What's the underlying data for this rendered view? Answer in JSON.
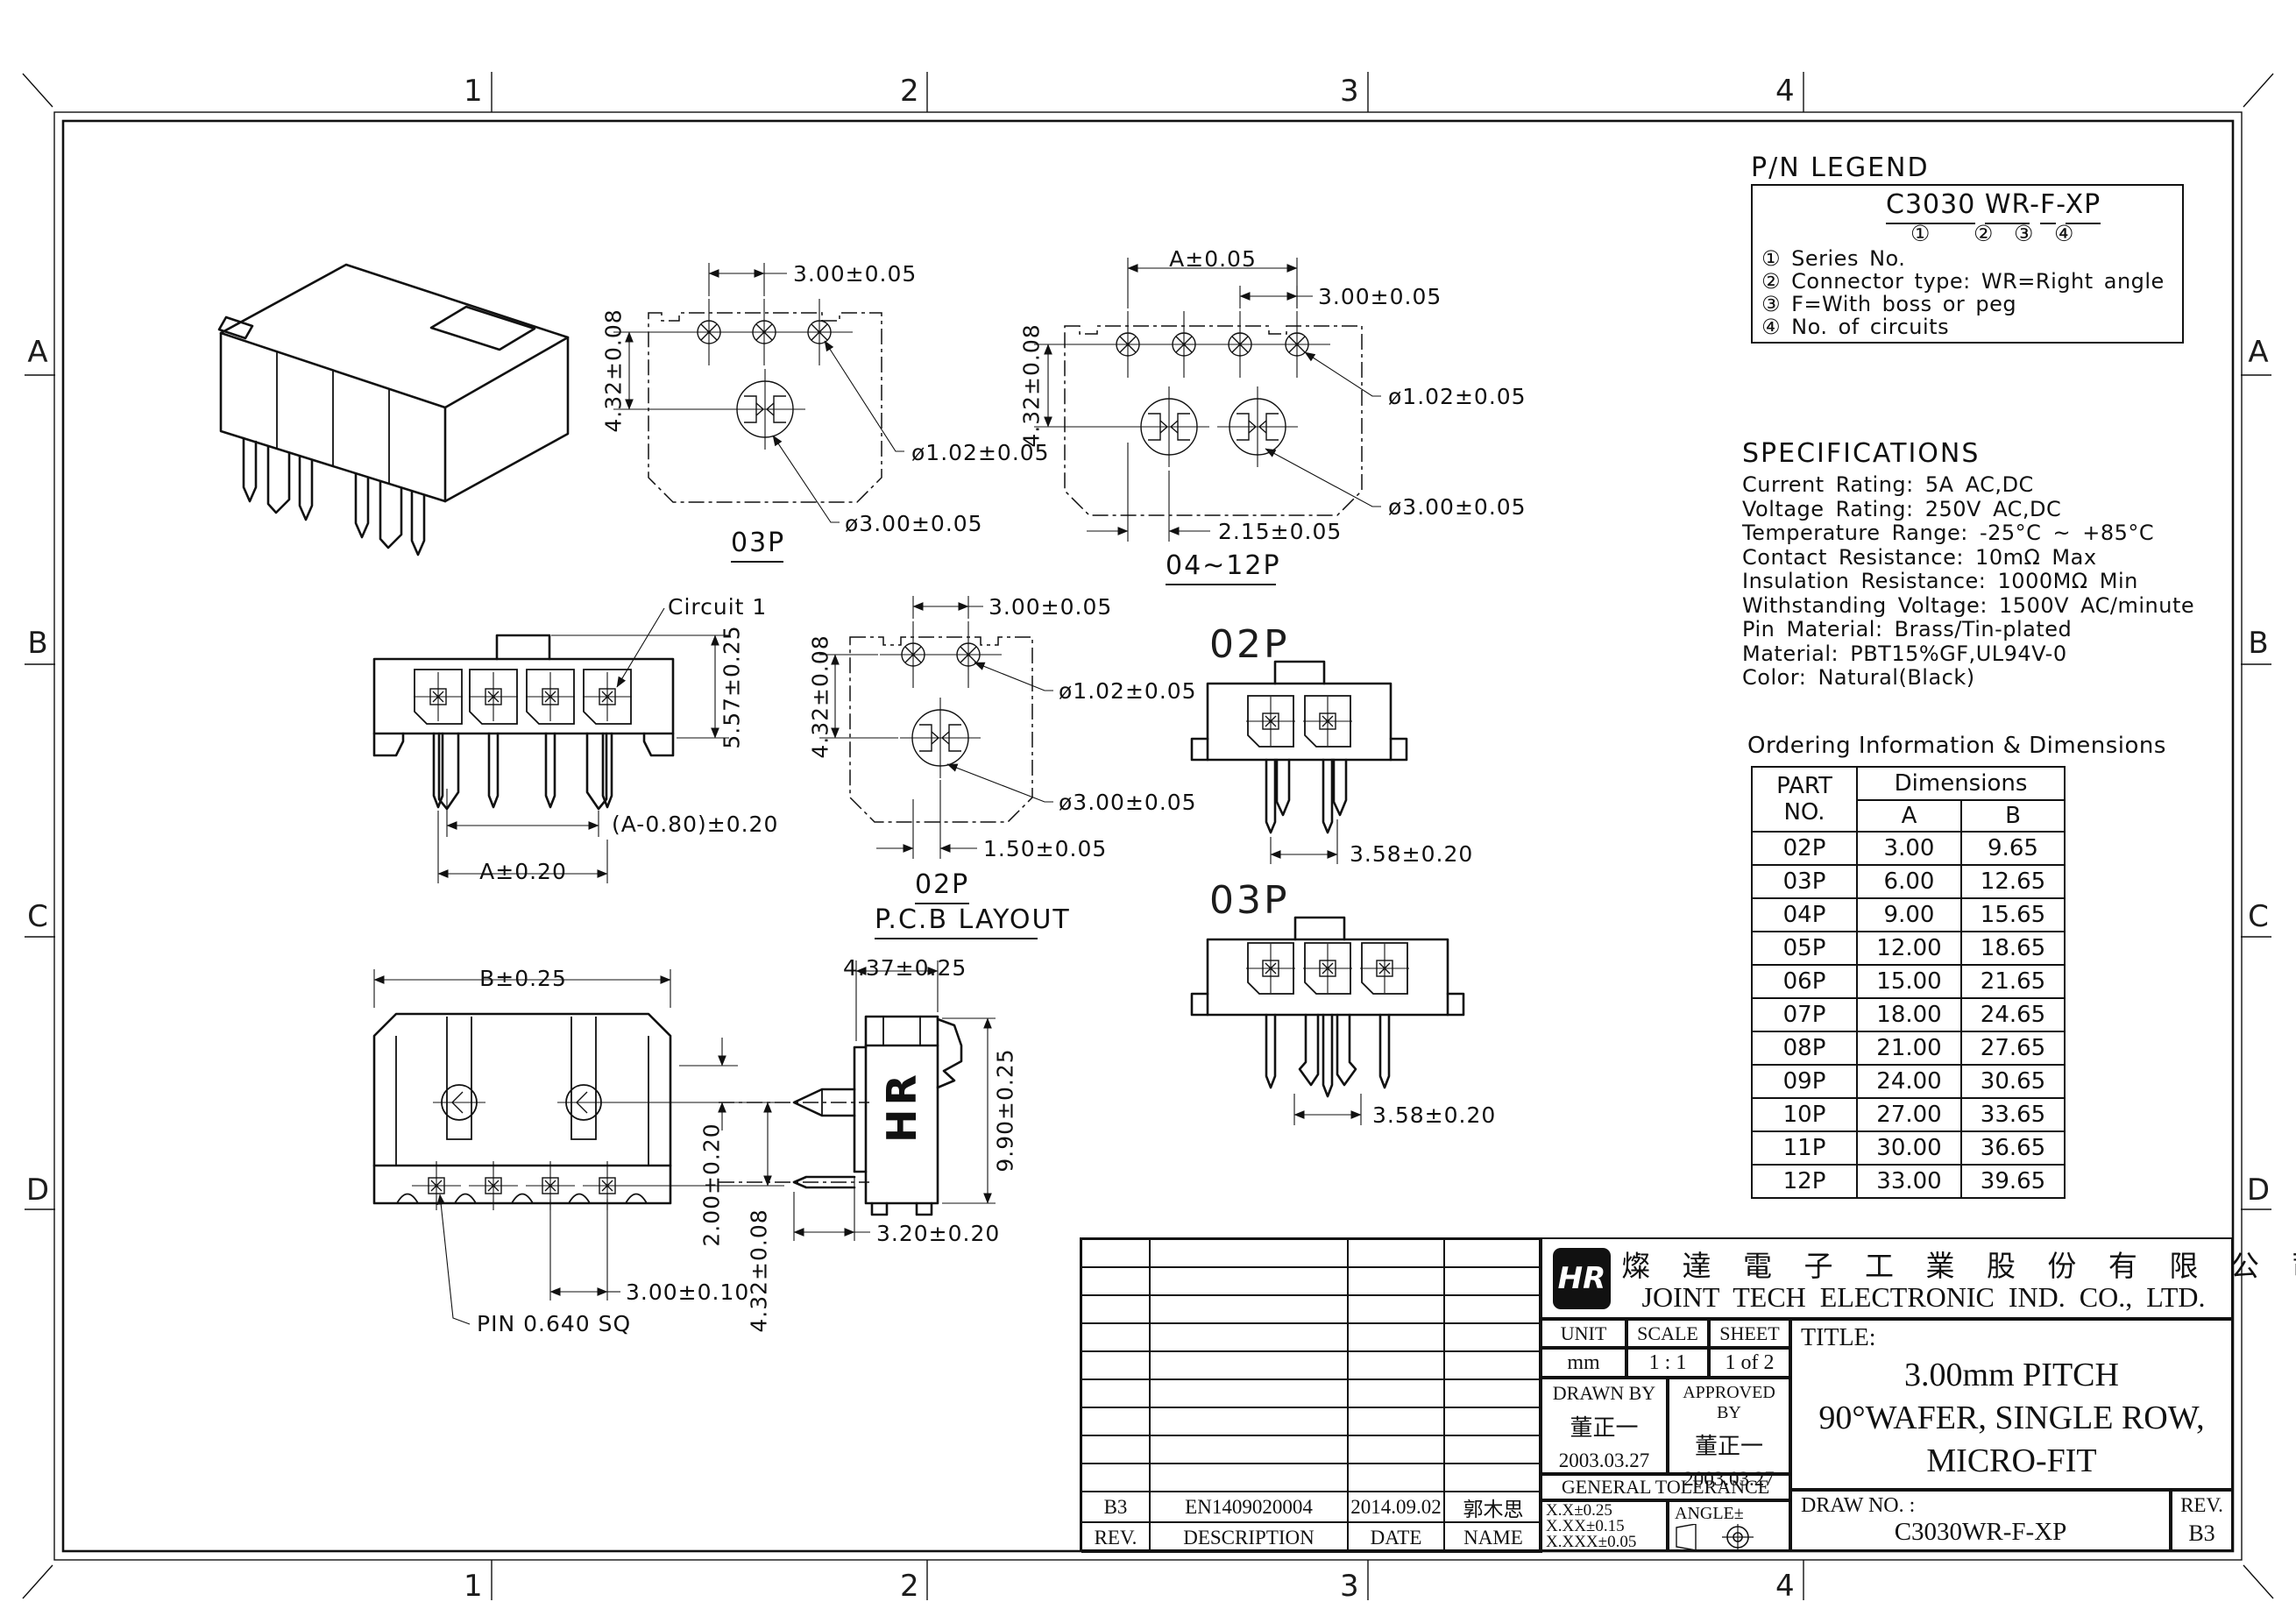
{
  "sheet": {
    "cols": [
      "1",
      "2",
      "3",
      "4"
    ],
    "rows": [
      "A",
      "B",
      "C",
      "D"
    ]
  },
  "legend": {
    "title": "P/N LEGEND",
    "pn_series": "C3030",
    "pn_type": "WR",
    "pn_sep": "-",
    "pn_boss": "F",
    "pn_circuits": "XP",
    "marks": [
      "①",
      "②",
      "③",
      "④"
    ],
    "items": [
      "① Series No.",
      "② Connector type: WR=Right angle",
      "③ F=With boss or peg",
      "④ No. of circuits"
    ]
  },
  "specs": {
    "title": "SPECIFICATIONS",
    "lines": [
      "Current Rating: 5A AC,DC",
      "Voltage Rating: 250V AC,DC",
      "Temperature Range: -25°C ~ +85°C",
      "Contact Resistance: 10mΩ Max",
      "Insulation Resistance: 1000MΩ Min",
      "Withstanding Voltage: 1500V AC/minute",
      "Pin Material: Brass/Tin-plated",
      "Material: PBT15%GF,UL94V-0",
      "Color: Natural(Black)"
    ]
  },
  "ordering": {
    "title": "Ordering Information & Dimensions",
    "h_part1": "PART",
    "h_part2": "NO.",
    "h_dim": "Dimensions",
    "h_a": "A",
    "h_b": "B",
    "rows": [
      {
        "p": "02P",
        "a": "3.00",
        "b": "9.65"
      },
      {
        "p": "03P",
        "a": "6.00",
        "b": "12.65"
      },
      {
        "p": "04P",
        "a": "9.00",
        "b": "15.65"
      },
      {
        "p": "05P",
        "a": "12.00",
        "b": "18.65"
      },
      {
        "p": "06P",
        "a": "15.00",
        "b": "21.65"
      },
      {
        "p": "07P",
        "a": "18.00",
        "b": "24.65"
      },
      {
        "p": "08P",
        "a": "21.00",
        "b": "27.65"
      },
      {
        "p": "09P",
        "a": "24.00",
        "b": "30.65"
      },
      {
        "p": "10P",
        "a": "27.00",
        "b": "33.65"
      },
      {
        "p": "11P",
        "a": "30.00",
        "b": "36.65"
      },
      {
        "p": "12P",
        "a": "33.00",
        "b": "39.65"
      }
    ]
  },
  "views": {
    "v03p_top": {
      "pitch": "3.00±0.05",
      "row": "4.32±0.08",
      "pad": "ø1.02±0.05",
      "hole": "ø3.00±0.05",
      "label": "03P"
    },
    "v0412_top": {
      "a": "A±0.05",
      "pitch": "3.00±0.05",
      "row": "4.32±0.08",
      "pad": "ø1.02±0.05",
      "hole": "ø3.00±0.05",
      "offset": "2.15±0.05",
      "label": "04~12P"
    },
    "front": {
      "circuit": "Circuit 1",
      "height": "5.57±0.25",
      "peg_span": "(A-0.80)±0.20",
      "span": "A±0.20"
    },
    "v02p_top": {
      "pitch": "3.00±0.05",
      "row": "4.32±0.08",
      "pad": "ø1.02±0.05",
      "hole": "ø3.00±0.05",
      "offset": "1.50±0.05",
      "label": "02P",
      "caption": "P.C.B LAYOUT"
    },
    "c02p": {
      "label": "02P",
      "dim": "3.58±0.20"
    },
    "c03p": {
      "label": "03P",
      "dim": "3.58±0.20"
    },
    "bottom": {
      "width": "B±0.25",
      "pitch": "3.00±0.10",
      "pin": "PIN 0.640 SQ",
      "drop": "2.00±0.20",
      "rows": "4.32±0.08"
    },
    "side": {
      "depth": "4.37±0.25",
      "height": "9.90±0.25",
      "tail": "3.20±0.20",
      "logo": "HR"
    }
  },
  "tb": {
    "logo": "HR",
    "company_cjk": "燦 達 電 子 工 業 股 份 有 限 公 司",
    "company_en": "JOINT TECH ELECTRONIC IND. CO., LTD.",
    "unit_label": "UNIT",
    "unit_value": "mm",
    "scale_label": "SCALE",
    "scale_value": "1 : 1",
    "sheet_label": "SHEET",
    "sheet_value": "1 of 2",
    "drawn_label": "DRAWN BY",
    "drawn_name": "董正一",
    "drawn_date": "2003.03.27",
    "approved_label": "APPROVED BY",
    "approved_name": "董正一",
    "approved_date": "2003.03.27",
    "tolerance_title": "GENERAL TOLERANCE",
    "tol1": "X.X±0.25",
    "tol2": "X.XX±0.15",
    "tol3": "X.XXX±0.05",
    "angle_label": "ANGLE±",
    "title_label": "TITLE:",
    "title1": "3.00mm PITCH",
    "title2": "90°WAFER, SINGLE ROW,",
    "title3": "MICRO-FIT",
    "drawno_label": "DRAW NO. :",
    "drawno_value": "C3030WR-F-XP",
    "rev_label": "REV.",
    "rev_value": "B3"
  },
  "rev_table": {
    "h_rev": "REV.",
    "h_desc": "DESCRIPTION",
    "h_date": "DATE",
    "h_name": "NAME",
    "e_rev": "B3",
    "e_desc": "EN1409020004",
    "e_date": "2014.09.02",
    "e_name": "郭木思"
  }
}
